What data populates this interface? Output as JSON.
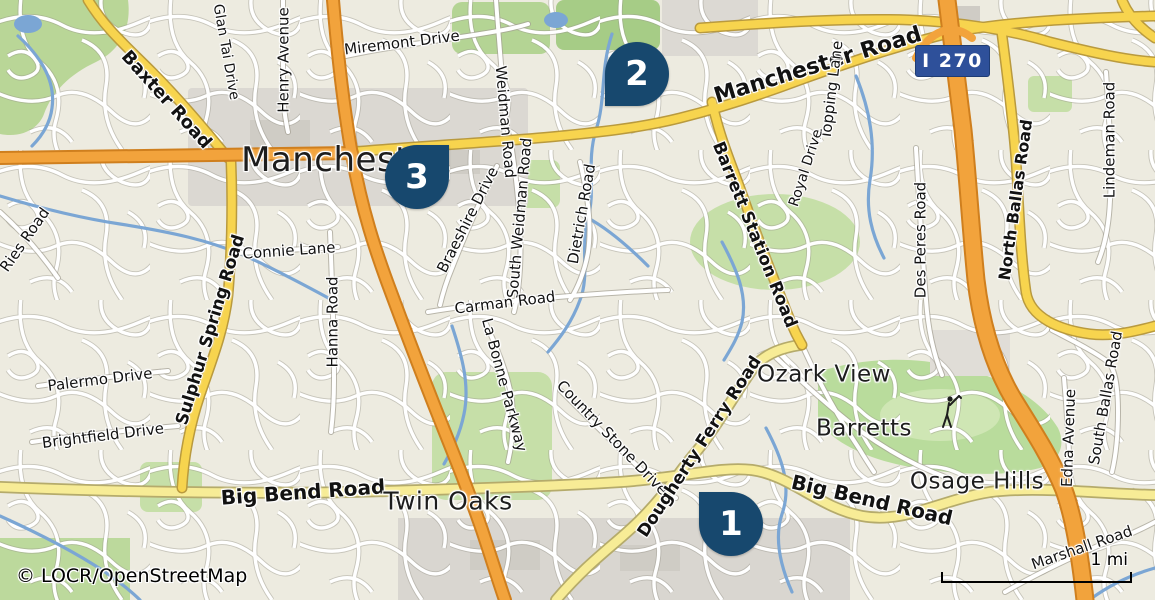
{
  "map": {
    "attribution": "© LOCR/OpenStreetMap",
    "scale": {
      "label": "1 mi"
    },
    "shield": {
      "label": "I 270"
    },
    "colors": {
      "pin": "#17486e",
      "shield": "#2e509a",
      "land": "#edebe0",
      "road_yellow": "#f7d44e",
      "road_pale_yellow": "#f7ec96",
      "road_orange": "#f2a33c",
      "water": "#7ba6d4",
      "green": "#c3dda4"
    },
    "markers": [
      {
        "number": "1",
        "cx": 731,
        "cy": 524,
        "tip": "tl"
      },
      {
        "number": "2",
        "cx": 637,
        "cy": 74,
        "tip": "bl"
      },
      {
        "number": "3",
        "cx": 417,
        "cy": 177,
        "tip": "tr"
      }
    ],
    "place_labels": [
      {
        "text": "Manchester",
        "x": 343,
        "y": 160,
        "size": 34
      },
      {
        "text": "Twin Oaks",
        "x": 448,
        "y": 501,
        "size": 25
      },
      {
        "text": "Ozark View",
        "x": 824,
        "y": 375,
        "size": 23
      },
      {
        "text": "Barretts",
        "x": 864,
        "y": 429,
        "size": 23
      },
      {
        "text": "Osage Hills",
        "x": 977,
        "y": 482,
        "size": 23
      }
    ],
    "road_labels": [
      {
        "text": "Baxter Road",
        "x": 166,
        "y": 100,
        "rot": 48,
        "size": 18,
        "weight": 600
      },
      {
        "text": "Miremont Drive",
        "x": 402,
        "y": 43,
        "rot": -7,
        "size": 15,
        "weight": 400
      },
      {
        "text": "Glan Tai Drive",
        "x": 226,
        "y": 52,
        "rot": 80,
        "size": 14,
        "weight": 400
      },
      {
        "text": "Henry Avenue",
        "x": 284,
        "y": 60,
        "rot": -90,
        "size": 15,
        "weight": 400
      },
      {
        "text": "Weidman Road",
        "x": 505,
        "y": 122,
        "rot": 85,
        "size": 15,
        "weight": 400
      },
      {
        "text": "Manchester Road",
        "x": 818,
        "y": 66,
        "rot": -17,
        "size": 22,
        "weight": 700
      },
      {
        "text": "Topping Lane",
        "x": 832,
        "y": 90,
        "rot": -83,
        "size": 15,
        "weight": 400
      },
      {
        "text": "Royal Drive",
        "x": 806,
        "y": 168,
        "rot": -72,
        "size": 14,
        "weight": 400
      },
      {
        "text": "Lindeman Road",
        "x": 1110,
        "y": 140,
        "rot": -90,
        "size": 15,
        "weight": 400
      },
      {
        "text": "North Ballas Road",
        "x": 1016,
        "y": 200,
        "rot": -82,
        "size": 16,
        "weight": 600
      },
      {
        "text": "Des Peres Road",
        "x": 921,
        "y": 240,
        "rot": -90,
        "size": 15,
        "weight": 400
      },
      {
        "text": "Barrett Station Road",
        "x": 754,
        "y": 235,
        "rot": 68,
        "size": 17,
        "weight": 600
      },
      {
        "text": "Sulphur Spring Road",
        "x": 211,
        "y": 330,
        "rot": -73,
        "size": 17,
        "weight": 600
      },
      {
        "text": "Connie Lane",
        "x": 289,
        "y": 251,
        "rot": -4,
        "size": 15,
        "weight": 400
      },
      {
        "text": "Hanna Road",
        "x": 333,
        "y": 322,
        "rot": -90,
        "size": 15,
        "weight": 400
      },
      {
        "text": "Ries Road",
        "x": 25,
        "y": 240,
        "rot": -55,
        "size": 15,
        "weight": 400
      },
      {
        "text": "Braeshire Drive",
        "x": 468,
        "y": 220,
        "rot": -63,
        "size": 15,
        "weight": 400
      },
      {
        "text": "South Weidman Road",
        "x": 520,
        "y": 218,
        "rot": -85,
        "size": 15,
        "weight": 400
      },
      {
        "text": "Dietrich Road",
        "x": 582,
        "y": 214,
        "rot": -80,
        "size": 15,
        "weight": 400
      },
      {
        "text": "Carman Road",
        "x": 505,
        "y": 303,
        "rot": -7,
        "size": 15,
        "weight": 400
      },
      {
        "text": "La Bonne Parkway",
        "x": 504,
        "y": 385,
        "rot": 75,
        "size": 15,
        "weight": 400
      },
      {
        "text": "Country Stone Drive",
        "x": 612,
        "y": 438,
        "rot": 46,
        "size": 15,
        "weight": 400
      },
      {
        "text": "Dougherty Ferry Road",
        "x": 700,
        "y": 447,
        "rot": -57,
        "size": 17,
        "weight": 600
      },
      {
        "text": "Palermo Drive",
        "x": 100,
        "y": 380,
        "rot": -7,
        "size": 15,
        "weight": 400
      },
      {
        "text": "Brightfield Drive",
        "x": 103,
        "y": 436,
        "rot": -7,
        "size": 15,
        "weight": 400
      },
      {
        "text": "Big Bend Road",
        "x": 303,
        "y": 492,
        "rot": -4,
        "size": 20,
        "weight": 700
      },
      {
        "text": "Big Bend Road",
        "x": 872,
        "y": 500,
        "rot": 13,
        "size": 20,
        "weight": 700
      },
      {
        "text": "Edna Avenue",
        "x": 1069,
        "y": 438,
        "rot": -88,
        "size": 15,
        "weight": 400
      },
      {
        "text": "South Ballas Road",
        "x": 1106,
        "y": 398,
        "rot": -80,
        "size": 15,
        "weight": 400
      },
      {
        "text": "Marshall Road",
        "x": 1082,
        "y": 548,
        "rot": -19,
        "size": 15,
        "weight": 400
      }
    ],
    "icons": [
      {
        "name": "golfer-icon",
        "meaning": "golf course"
      }
    ]
  }
}
